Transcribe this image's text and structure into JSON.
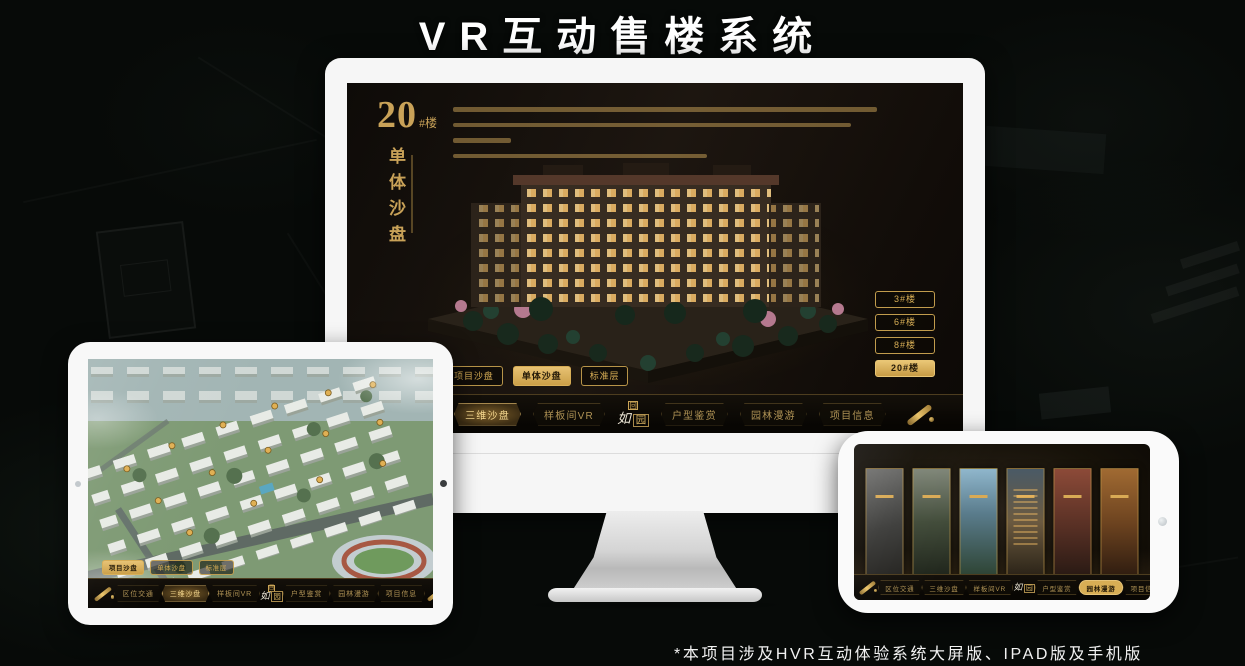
{
  "page": {
    "title": "VR互动售楼系统",
    "footnote": "*本项目涉及HVR互动体验系统大屏版、IPAD版及手机版"
  },
  "colors": {
    "gold": "#d8ae55",
    "gold_dim": "#b09355",
    "screen_brown": "#17120c",
    "device_frame": "#f7f7f7",
    "active_text": "#f5d88f"
  },
  "icons": {
    "scroll": "gold-scroll",
    "seal_glyph": "回",
    "camera": "camera-dot"
  },
  "nav": {
    "items": [
      {
        "label": "区位交通"
      },
      {
        "label": "三维沙盘"
      },
      {
        "label": "样板间VR"
      },
      {
        "label": "户型鉴赏"
      },
      {
        "label": "园林漫游"
      },
      {
        "label": "项目信息"
      }
    ],
    "logo": {
      "char1": "如",
      "char2": "园"
    }
  },
  "monitor": {
    "headline": {
      "number": "20",
      "suffix": "#楼",
      "subtitle": "单体沙盘"
    },
    "floor_buttons": [
      {
        "label": "3#楼",
        "active": false
      },
      {
        "label": "6#楼",
        "active": false
      },
      {
        "label": "8#楼",
        "active": false
      },
      {
        "label": "20#楼",
        "active": true
      }
    ],
    "sub_tabs": [
      {
        "label": "项目沙盘",
        "active": false
      },
      {
        "label": "单体沙盘",
        "active": true
      },
      {
        "label": "标准层",
        "active": false
      }
    ]
  },
  "tablet": {
    "sub_tabs": [
      {
        "label": "项目沙盘",
        "active": true
      },
      {
        "label": "单体沙盘",
        "active": false
      },
      {
        "label": "标准层",
        "active": false
      }
    ]
  }
}
